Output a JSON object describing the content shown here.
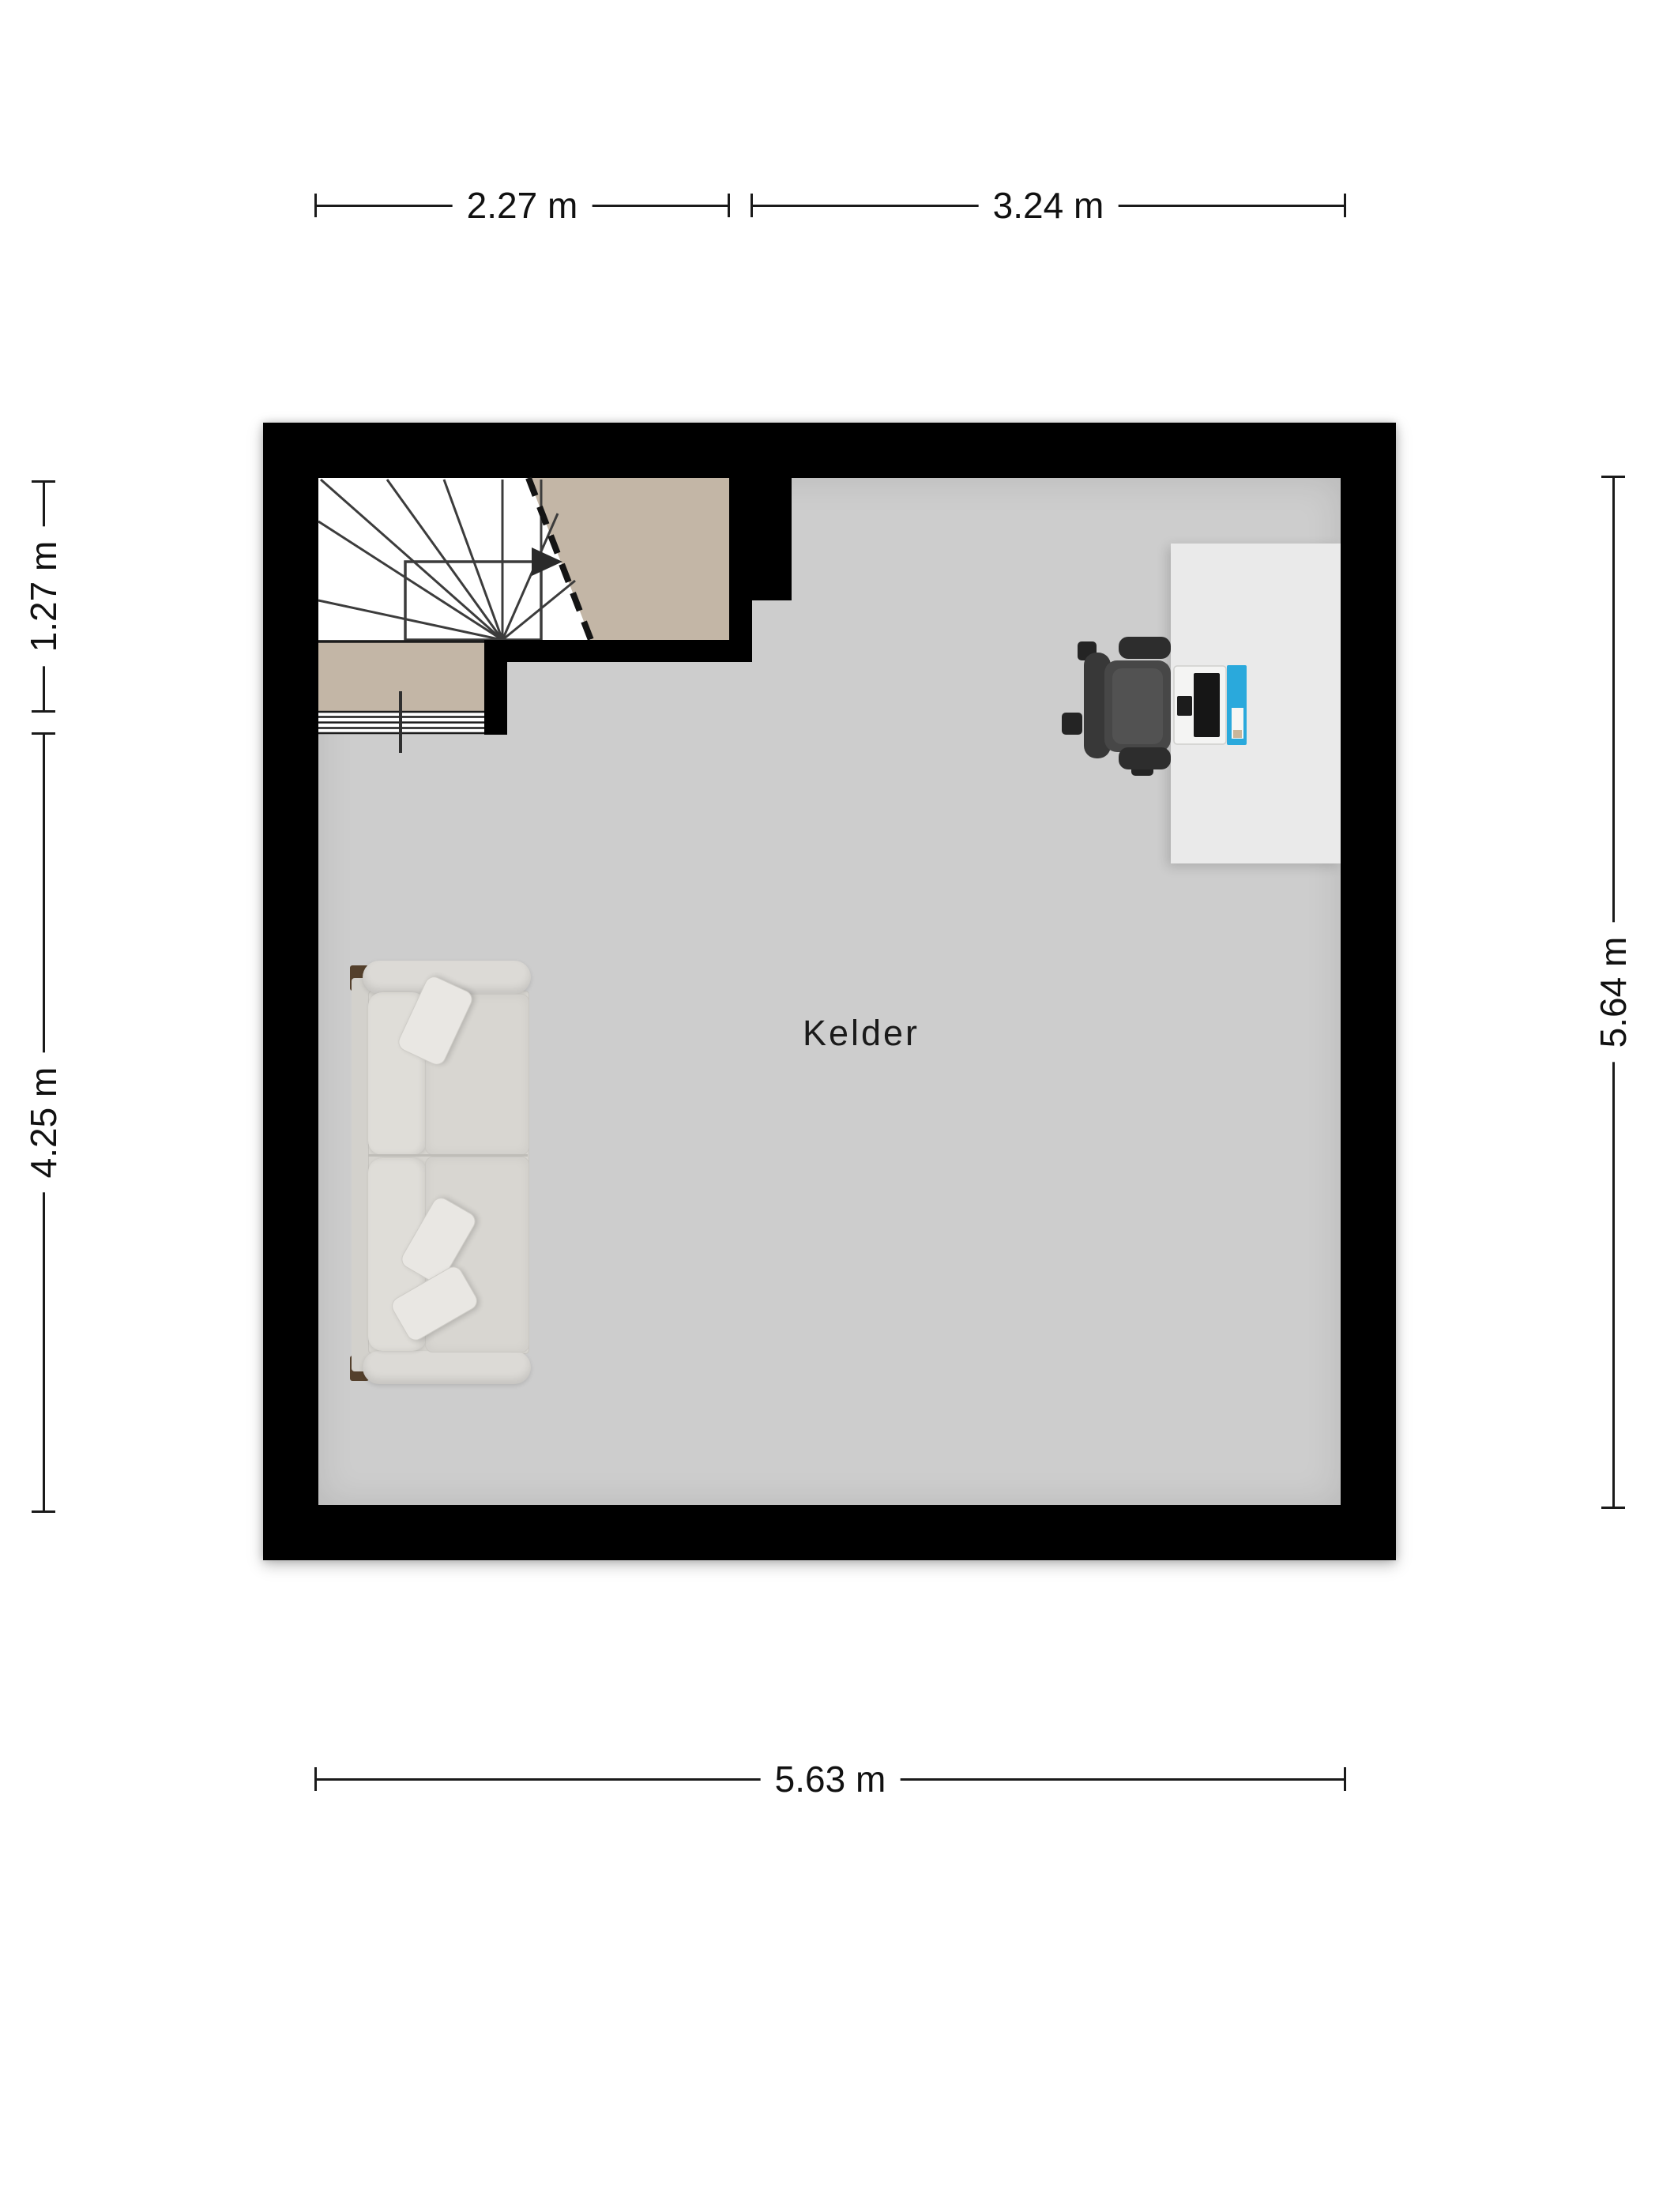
{
  "room": {
    "label": "Kelder"
  },
  "dimensions": {
    "top": [
      {
        "label": "2.27 m"
      },
      {
        "label": "3.24 m"
      }
    ],
    "left": [
      {
        "label": "1.27 m"
      },
      {
        "label": "4.25 m"
      }
    ],
    "right": [
      {
        "label": "5.64 m"
      }
    ],
    "bottom": [
      {
        "label": "5.63 m"
      }
    ]
  },
  "colors": {
    "wall": "#000000",
    "floor": "#cdcdcd",
    "stair-bg": "#ffffff",
    "landing": "#c3b6a6",
    "desk": "#eaeaea",
    "chair-back": "#383838",
    "chair-mid": "#474747",
    "chair-dark": "#2d2d2d",
    "sofa-body": "#dcdad6",
    "sofa-cushion": "#d8d6d1",
    "sofa-back-cushion": "#dfddd8",
    "sofa-pillow": "#e9e7e3",
    "sofa-foot": "#54402c",
    "screen-blue": "#2aa9dc",
    "ink": "#1a1a1a",
    "page": "#ffffff"
  }
}
